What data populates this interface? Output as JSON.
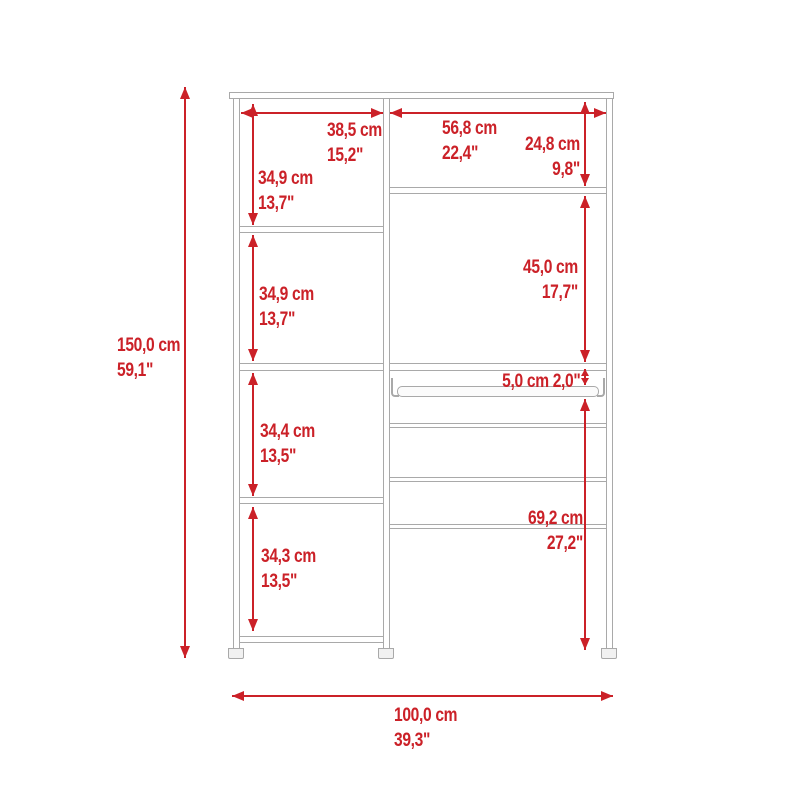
{
  "diagram": {
    "kind": "furniture-dimension-diagram",
    "subject": "two-column closet / shelving system front elevation",
    "colors": {
      "dimension_red": "#cb2128",
      "furniture_line_gray": "#a9a9a9",
      "background": "#ffffff"
    },
    "dims": {
      "overall_height": {
        "cm": "150,0 cm",
        "in": "59,1\""
      },
      "overall_width": {
        "cm": "100,0 cm",
        "in": "39,3\""
      },
      "left_column_width": {
        "cm": "38,5 cm",
        "in": "15,2\""
      },
      "right_column_width": {
        "cm": "56,8 cm",
        "in": "22,4\""
      },
      "left_section_1": {
        "cm": "34,9 cm",
        "in": "13,7\""
      },
      "left_section_2": {
        "cm": "34,9 cm",
        "in": "13,7\""
      },
      "left_section_3": {
        "cm": "34,4 cm",
        "in": "13,5\""
      },
      "left_section_4": {
        "cm": "34,3 cm",
        "in": "13,5\""
      },
      "right_top_section": {
        "cm": "24,8 cm",
        "in": "9,8\""
      },
      "right_middle_section": {
        "cm": "45,0 cm",
        "in": "17,7\""
      },
      "rod_clearance": {
        "combined": "5,0 cm 2,0\""
      },
      "right_bottom_section": {
        "cm": "69,2 cm",
        "in": "27,2\""
      }
    }
  }
}
